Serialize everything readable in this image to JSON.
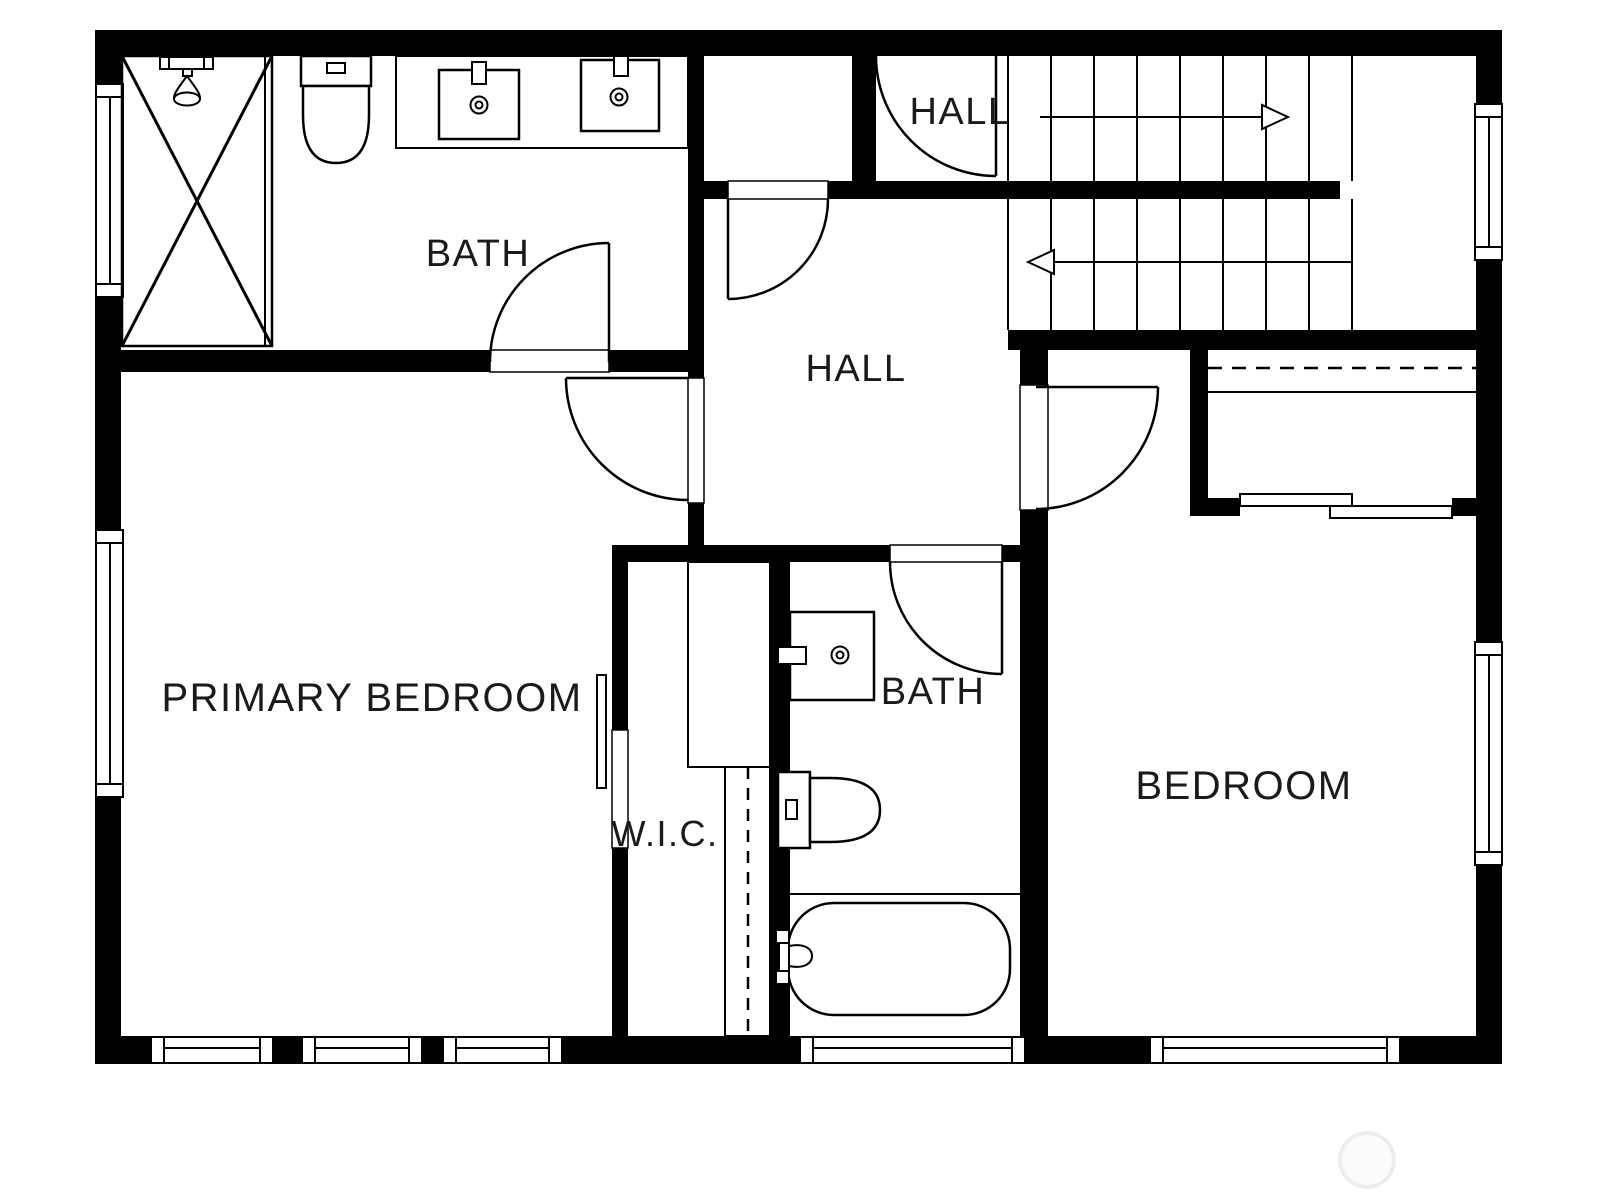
{
  "plan_type": "floor-plan",
  "colors": {
    "wall": "#000000",
    "background": "#ffffff",
    "label_text": "#1a1a1a",
    "watermark": "#ededed"
  },
  "rooms": [
    {
      "id": "bath-primary",
      "label": "BATH",
      "fixtures": [
        "shower",
        "toilet",
        "double-sink-vanity"
      ]
    },
    {
      "id": "hall-upper",
      "label": "HALL",
      "fixtures": [
        "staircase-up-run",
        "door"
      ]
    },
    {
      "id": "hall-main",
      "label": "HALL",
      "fixtures": [
        "staircase-lower-run",
        "doors"
      ]
    },
    {
      "id": "primary-bedroom",
      "label": "PRIMARY BEDROOM",
      "fixtures": [
        "windows",
        "sliding-closet-door"
      ]
    },
    {
      "id": "wic",
      "label": "W.I.C.",
      "fixtures": [
        "closet-shelves",
        "closet-rod"
      ]
    },
    {
      "id": "bath-hall",
      "label": "BATH",
      "fixtures": [
        "sink-vanity",
        "toilet",
        "bathtub"
      ]
    },
    {
      "id": "bedroom",
      "label": "BEDROOM",
      "fixtures": [
        "closet-rod",
        "sliding-closet-doors",
        "windows"
      ]
    }
  ],
  "stairs": {
    "upper_arrow_direction": "right",
    "lower_arrow_direction": "left"
  }
}
